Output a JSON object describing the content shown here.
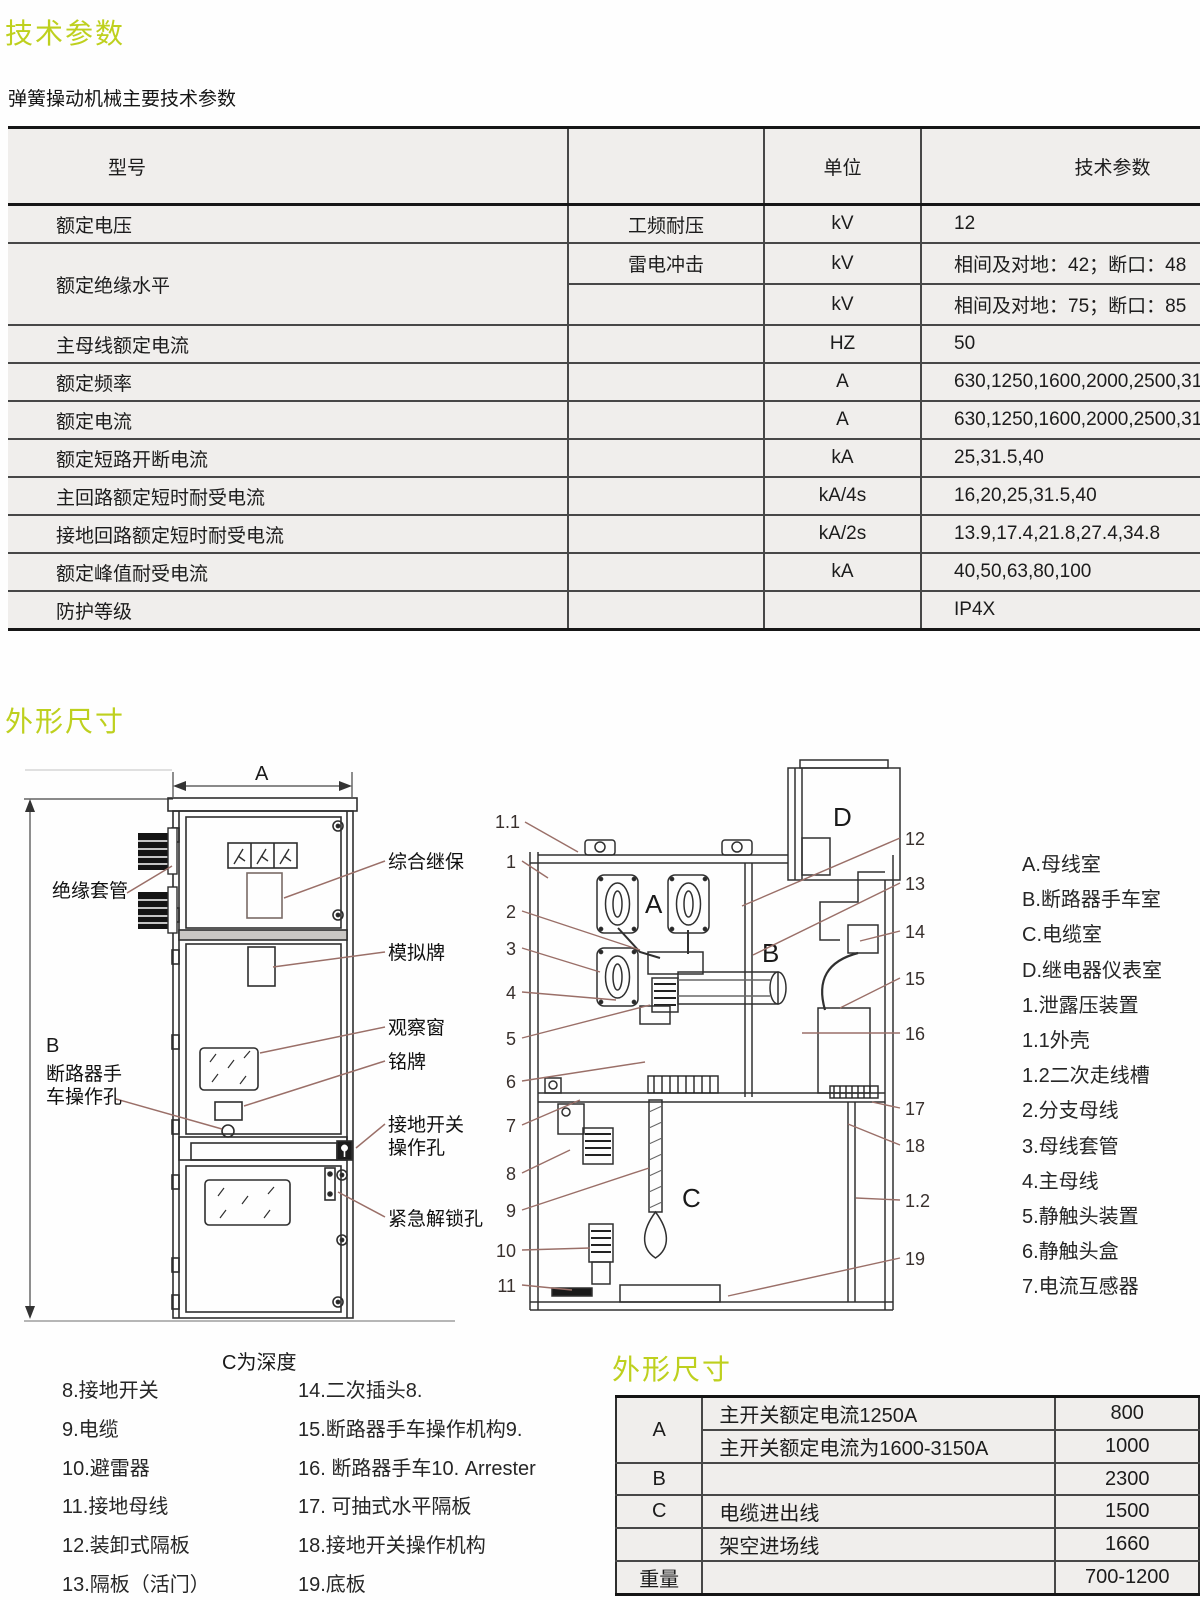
{
  "page": {
    "title1": "技术参数",
    "subtitle": "弹簧操动机械主要技术参数",
    "title2": "外形尺寸",
    "title3": "外形尺寸",
    "depth_note": "C为深度"
  },
  "table1": {
    "headers": {
      "model": "型号",
      "sub": "",
      "unit": "单位",
      "params": "技术参数"
    },
    "rows": [
      {
        "c1": "额定电压",
        "c2": "工频耐压",
        "c3": "kV",
        "c4": "12"
      },
      {
        "c1": "额定绝缘水平",
        "c2": "雷电冲击",
        "c3": "kV",
        "c4": "相间及对地：42；断口：48"
      },
      {
        "c1": "",
        "c2": "",
        "c3": "kV",
        "c4": "相间及对地：75；断口：85"
      },
      {
        "c1": "主母线额定电流",
        "c2": "",
        "c3": "HZ",
        "c4": "50"
      },
      {
        "c1": "额定频率",
        "c2": "",
        "c3": "A",
        "c4": "630,1250,1600,2000,2500,3150"
      },
      {
        "c1": "额定电流",
        "c2": "",
        "c3": "A",
        "c4": "630,1250,1600,2000,2500,3150"
      },
      {
        "c1": "额定短路开断电流",
        "c2": "",
        "c3": "kA",
        "c4": "25,31.5,40"
      },
      {
        "c1": "主回路额定短时耐受电流",
        "c2": "",
        "c3": "kA/4s",
        "c4": "16,20,25,31.5,40"
      },
      {
        "c1": "接地回路额定短时耐受电流",
        "c2": "",
        "c3": "kA/2s",
        "c4": "13.9,17.4,21.8,27.4,34.8"
      },
      {
        "c1": "额定峰值耐受电流",
        "c2": "",
        "c3": "kA",
        "c4": "40,50,63,80,100"
      },
      {
        "c1": "防护等级",
        "c2": "",
        "c3": "",
        "c4": "IP4X"
      }
    ]
  },
  "front_view": {
    "dim_width": "A",
    "dim_height": "B",
    "labels": {
      "bushing": "绝缘套管",
      "relay": "综合继保",
      "mimic": "模拟牌",
      "window": "观察窗",
      "nameplate": "铭牌",
      "breaker_hole_line1": "断路器手",
      "breaker_hole_line2": "车操作孔",
      "earth_switch_line1": "接地开关",
      "earth_switch_line2": "操作孔",
      "emergency": "紧急解锁孔"
    }
  },
  "section_view": {
    "compartments": {
      "a": "A",
      "b": "B",
      "c": "C",
      "d": "D"
    },
    "callouts_left": [
      "1.1",
      "1",
      "2",
      "3",
      "4",
      "5",
      "6",
      "7",
      "8",
      "9",
      "10",
      "11"
    ],
    "callouts_right": [
      "12",
      "13",
      "14",
      "15",
      "16",
      "17",
      "18",
      "1.2",
      "19"
    ]
  },
  "legend_right": [
    "A.母线室",
    "B.断路器手车室",
    "C.电缆室",
    "D.继电器仪表室",
    "1.泄露压装置",
    "1.1外壳",
    "1.2二次走线槽",
    "2.分支母线",
    "3.母线套管",
    "4.主母线",
    "5.静触头装置",
    "6.静触头盒",
    "7.电流互感器"
  ],
  "legend_bottom": {
    "col1": [
      "8.接地开关",
      "9.电缆",
      "10.避雷器",
      "11.接地母线",
      "12.装卸式隔板",
      "13.隔板（活门）"
    ],
    "col2": [
      "14.二次插头8.",
      "15.断路器手车操作机构9.",
      "16. 断路器手车10. Arrester",
      "17. 可抽式水平隔板",
      "18.接地开关操作机构",
      "19.底板"
    ]
  },
  "table2": {
    "rows": [
      {
        "k": "A",
        "desc": "主开关额定电流1250A",
        "val": "800"
      },
      {
        "k": "",
        "desc": "主开关额定电流为1600-3150A",
        "val": "1000"
      },
      {
        "k": "B",
        "desc": "",
        "val": "2300"
      },
      {
        "k": "C",
        "desc": "电缆进出线",
        "val": "1500"
      },
      {
        "k": "",
        "desc": "架空进场线",
        "val": "1660"
      },
      {
        "k": "重量",
        "desc": "",
        "val": "700-1200"
      }
    ]
  },
  "colors": {
    "accent_green": "#bed01e",
    "leader_line": "#9a6f68"
  }
}
